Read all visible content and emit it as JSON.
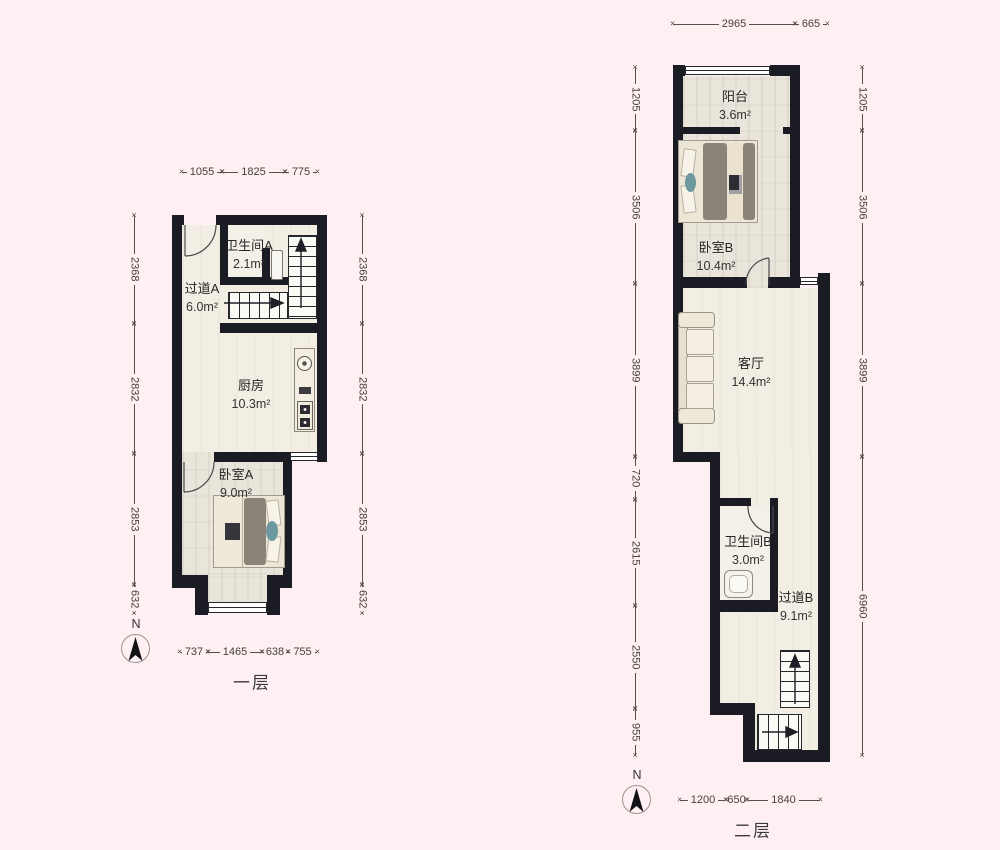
{
  "floor1": {
    "label": "一层",
    "compass": "N",
    "rooms": {
      "hallway": {
        "name": "过道A",
        "area": "6.0m²"
      },
      "bathroom": {
        "name": "卫生间A",
        "area": "2.1m²"
      },
      "kitchen": {
        "name": "厨房",
        "area": "10.3m²"
      },
      "bedroom": {
        "name": "卧室A",
        "area": "9.0m²"
      }
    },
    "dims": {
      "top": [
        "1055",
        "1825",
        "775"
      ],
      "bottom": [
        "737",
        "1465",
        "638",
        "755"
      ],
      "left": [
        "2368",
        "2832",
        "2853",
        "632"
      ],
      "right": [
        "2368",
        "2832",
        "2853",
        "632"
      ]
    }
  },
  "floor2": {
    "label": "二层",
    "compass": "N",
    "rooms": {
      "balcony": {
        "name": "阳台",
        "area": "3.6m²"
      },
      "bedroom": {
        "name": "卧室B",
        "area": "10.4m²"
      },
      "living": {
        "name": "客厅",
        "area": "14.4m²"
      },
      "bathroom": {
        "name": "卫生间B",
        "area": "3.0m²"
      },
      "hallway": {
        "name": "过道B",
        "area": "9.1m²"
      }
    },
    "dims": {
      "top": [
        "2965",
        "665"
      ],
      "bottom": [
        "1200",
        "650",
        "1840"
      ],
      "left": [
        "1205",
        "3506",
        "3899",
        "720",
        "2615",
        "2550",
        "955"
      ],
      "right": [
        "1205",
        "3506",
        "3899",
        "6960"
      ]
    }
  },
  "colors": {
    "background": "#fdeff2",
    "wall": "#1b1b24",
    "floor": "#f2eee3",
    "plank": "#e9e5da",
    "duvet": "#8b8278",
    "teal": "#6d98a0"
  }
}
